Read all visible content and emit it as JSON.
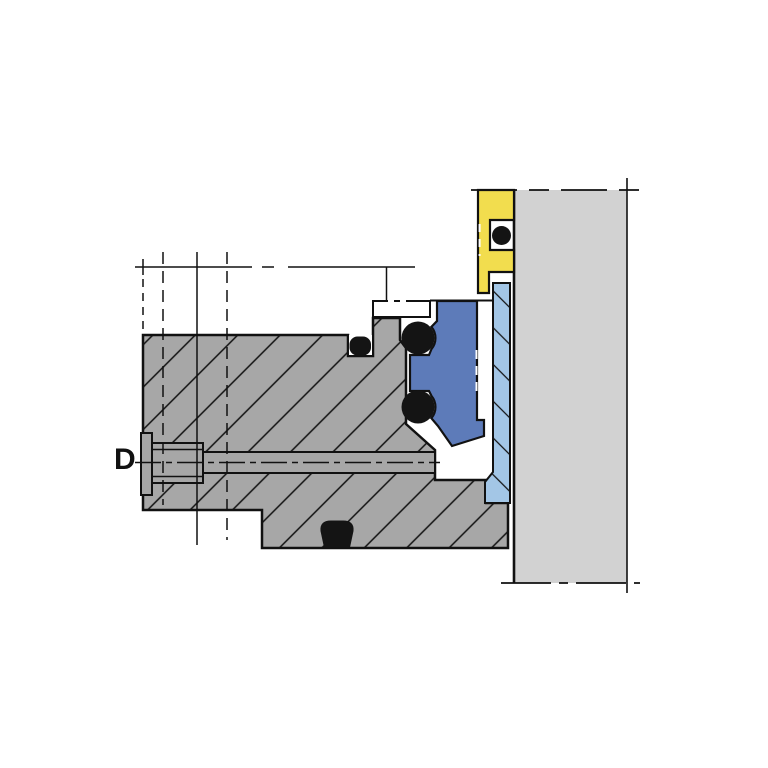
{
  "diagram": {
    "label_d": "D"
  },
  "colors": {
    "background": "#ffffff",
    "body_gray": "#a7a7a7",
    "bolt_gray": "#a7a7a7",
    "wall_gray": "#d2d2d2",
    "clamp_yellow": "#f2dd4e",
    "bellows_blue": "#5d7bb9",
    "seat_lightblue": "#a3c6e6",
    "oring_black": "#141414",
    "line_black": "#111111",
    "groove_white": "#ffffff"
  }
}
